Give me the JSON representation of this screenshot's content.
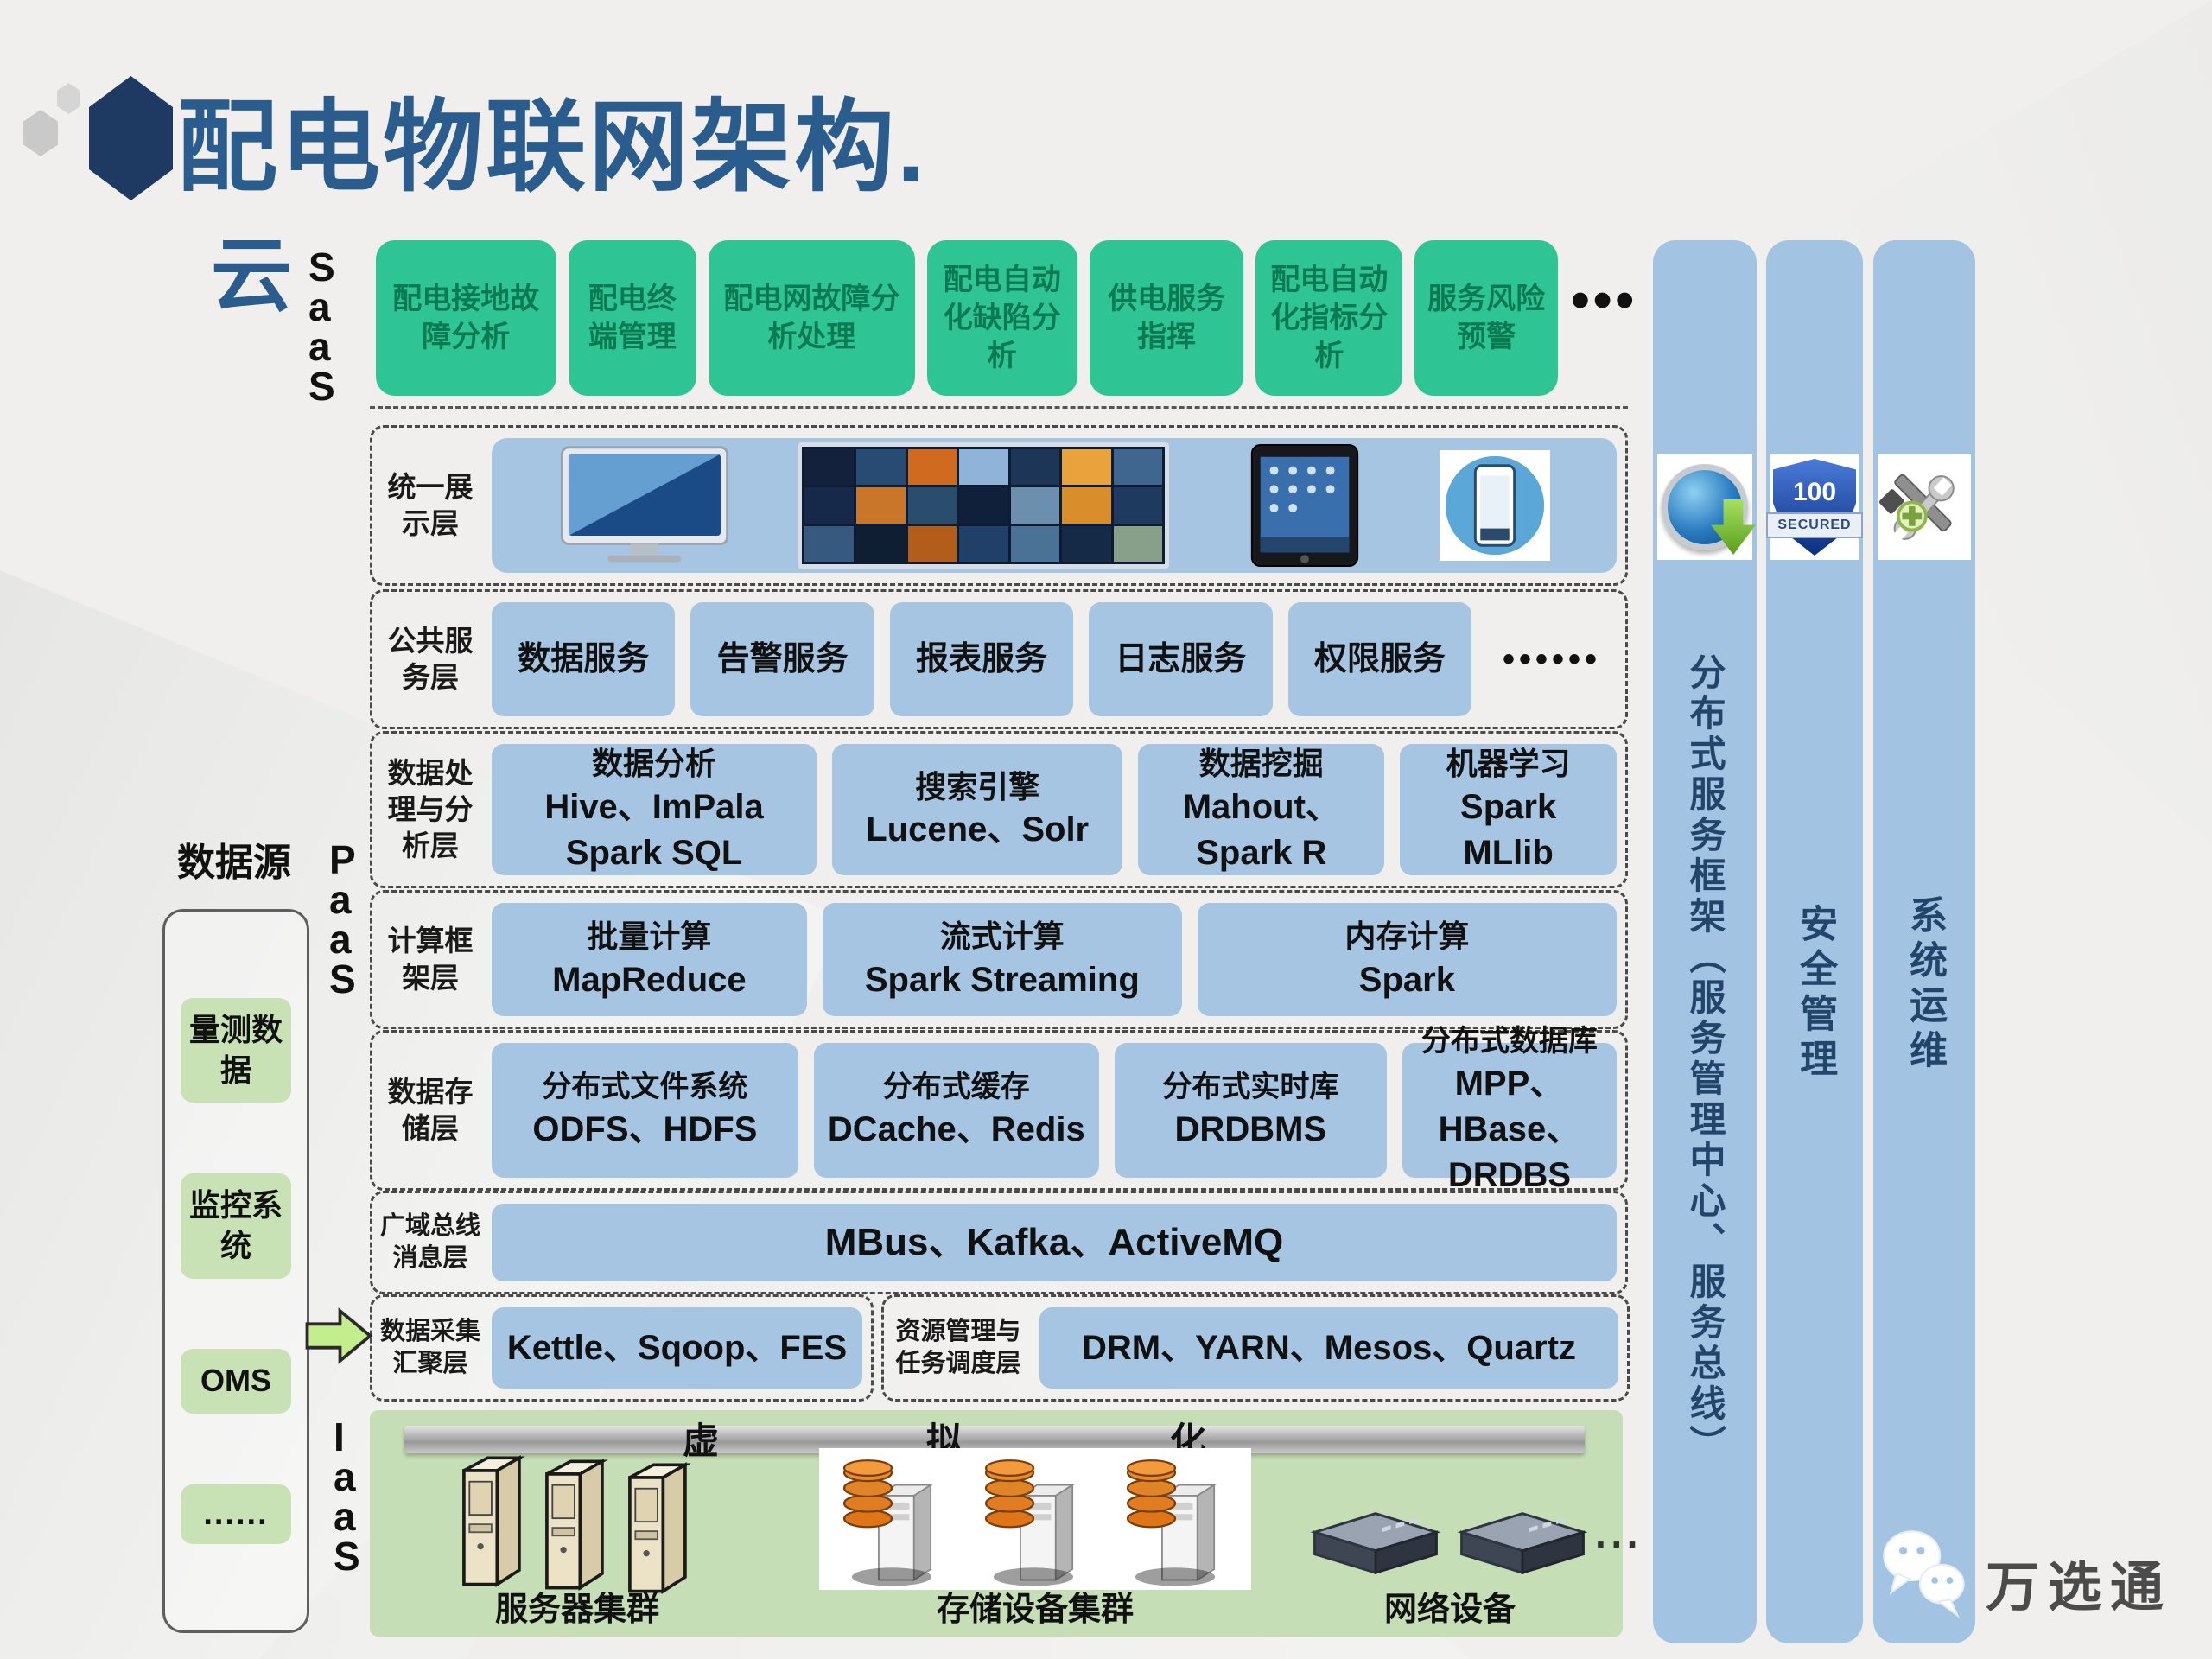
{
  "page": {
    "title": "配电物联网架构."
  },
  "left_rail": {
    "cloud": "云",
    "saas": "SaaS",
    "paas": "PaaS",
    "iaas": "IaaS"
  },
  "saas_layer": {
    "boxes": [
      "配电接地故障分析",
      "配电终端管理",
      "配电网故障分析处理",
      "配电自动化缺陷分析",
      "供电服务指挥",
      "配电自动化指标分析",
      "服务风险预警"
    ],
    "ellipsis": "•••"
  },
  "layers": {
    "display": {
      "label_lines": [
        "统一展",
        "示层"
      ],
      "devices": [
        "monitor-icon",
        "video-wall-icon",
        "tablet-icon",
        "smartphone-icon"
      ]
    },
    "common": {
      "label_lines": [
        "公共服",
        "务层"
      ],
      "boxes": [
        "数据服务",
        "告警服务",
        "报表服务",
        "日志服务",
        "权限服务"
      ],
      "ellipsis": "••••••"
    },
    "processing": {
      "label_lines": [
        "数据处",
        "理与分",
        "析层"
      ],
      "boxes": [
        {
          "l1": "数据分析",
          "l2": "Hive、ImPala",
          "l3": "Spark SQL"
        },
        {
          "l1": "搜索引擎",
          "l2": "Lucene、Solr",
          "l3": ""
        },
        {
          "l1": "数据挖掘",
          "l2": "Mahout、",
          "l3": "Spark R"
        },
        {
          "l1": "机器学习",
          "l2": "Spark",
          "l3": "MLlib"
        }
      ]
    },
    "compute": {
      "label_lines": [
        "计算框",
        "架层"
      ],
      "boxes": [
        {
          "l1": "批量计算",
          "l2": "MapReduce"
        },
        {
          "l1": "流式计算",
          "l2": "Spark Streaming"
        },
        {
          "l1": "内存计算",
          "l2": "Spark"
        }
      ]
    },
    "storage": {
      "label_lines": [
        "数据存",
        "储层"
      ],
      "boxes": [
        {
          "l1": "分布式文件系统",
          "b": "ODFS",
          "t": "、HDFS",
          "l3": ""
        },
        {
          "l1": "分布式缓存",
          "b": "DCache",
          "t": "、Redis",
          "l3": ""
        },
        {
          "l1": "分布式实时库",
          "b": "DRDBMS",
          "t": "",
          "l3": ""
        },
        {
          "l1": "分布式数据库",
          "b": "",
          "t": "MPP、HBase、",
          "l3": "DRDBS"
        }
      ]
    },
    "bus": {
      "label_lines": [
        "广域总线",
        "消息层"
      ],
      "b": "MBus",
      "t": "、Kafka、ActiveMQ"
    },
    "ingest": {
      "label_lines": [
        "数据采集",
        "汇聚层"
      ],
      "box": "Kettle、Sqoop、FES"
    },
    "scheduler": {
      "label_lines": [
        "资源管理与",
        "任务调度层"
      ],
      "b": "DRM",
      "t": "、YARN、Mesos、Quartz"
    }
  },
  "iaas": {
    "virtualization": "虚拟化",
    "groups": [
      {
        "icon": "server-tower-icon",
        "label": "服务器集群"
      },
      {
        "icon": "storage-array-icon",
        "label": "存储设备集群"
      },
      {
        "icon": "network-device-icon",
        "label": "网络设备"
      }
    ],
    "ellipsis": "···"
  },
  "datasource": {
    "title": "数据源",
    "items": [
      "量测数据",
      "监控系统",
      "OMS",
      "......"
    ]
  },
  "pillars": [
    {
      "icon": "globe-sync-icon",
      "label": "分布式服务框架（服务管理中心、服务总线）"
    },
    {
      "icon": "security-shield-icon",
      "label": "安全管理"
    },
    {
      "icon": "maintenance-tools-icon",
      "label": "系统运维"
    }
  ],
  "shield": {
    "value": "100",
    "banner": "SECURED"
  },
  "watermark": {
    "icon": "wechat-icon",
    "text": "万选通"
  },
  "colors": {
    "title_navy": "#2a5c8e",
    "logo_navy": "#1e3a63",
    "saas_green": "#2fc493",
    "saas_text_green": "#0b7a53",
    "layer_blue": "#a6c5e3",
    "pillar_blue": "#a3c3e2",
    "iaas_green": "#c5deb5",
    "datasource_green": "#c8e2b5",
    "arrow_green": "#c2ee8e"
  }
}
